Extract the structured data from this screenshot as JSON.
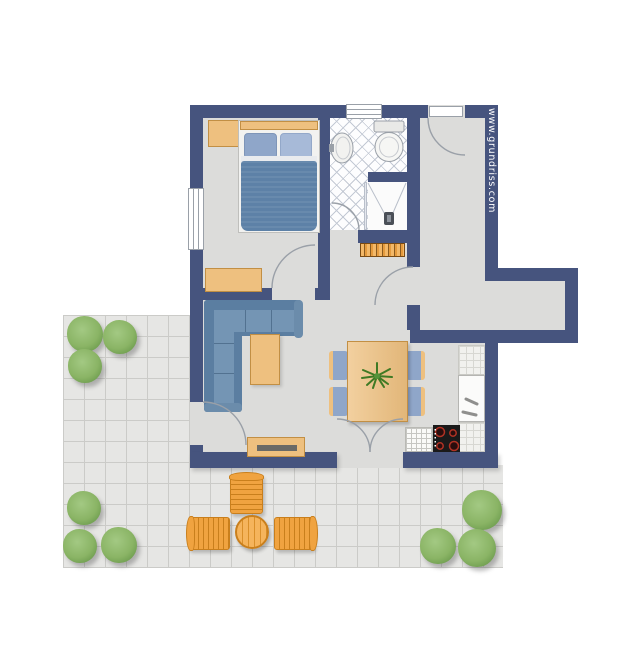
{
  "watermark": {
    "text": "www.grundriss.com",
    "color": "#ffffff"
  },
  "palette": {
    "wall": "#46547e",
    "floor": "#dcdcda",
    "bath": "#fdfdfe",
    "tileline": "#c3c9d4",
    "terrace": "#e6e6e4",
    "tgrid": "#cbcbc8",
    "wood": "#eec07f",
    "wood_dk": "#c28f44",
    "sofa": "#7495b4",
    "sofa_dk": "#5b7ea1",
    "blanket": "#5d81a7",
    "pillow1": "#8fa6c9",
    "pillow2": "#a7bad8",
    "orange": "#f0a340",
    "orange_dk": "#c97f1c",
    "plant1": "#a3c983",
    "plant2": "#6f9e50",
    "arc": "#9aa0a8",
    "cooktop": "#1a1a1a",
    "burner": "#b03224",
    "counter": "#f1f1ee",
    "countergrid": "#d7d7d2"
  },
  "elements": {
    "rooms": [
      "bedroom",
      "bathroom",
      "hall",
      "corridor",
      "living-dining",
      "kitchen",
      "terrace"
    ],
    "furniture": [
      "double-bed",
      "nightstand",
      "dresser",
      "corner-sofa",
      "coffee-table",
      "tv-lowboard",
      "dining-table",
      "dining-chair",
      "table-plant",
      "kitchen-sink",
      "cooktop",
      "kitchen-counter",
      "bath-sink",
      "toilet",
      "shower",
      "radiator",
      "outdoor-table",
      "outdoor-chair",
      "shrub"
    ],
    "openings": [
      "entrance-door",
      "bedroom-window",
      "bathroom-window",
      "bathroom-door",
      "hall-door",
      "terrace-door",
      "french-door"
    ]
  }
}
